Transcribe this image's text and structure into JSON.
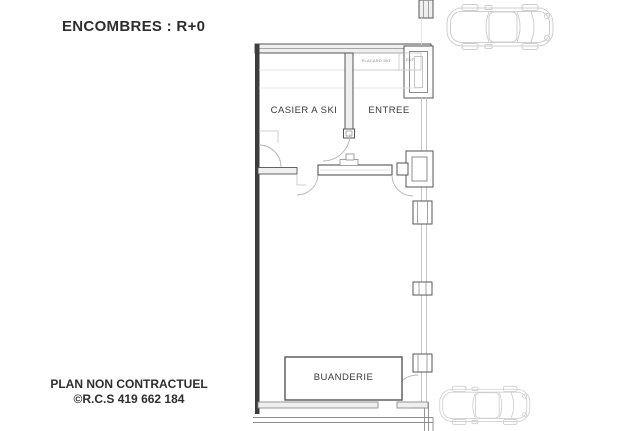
{
  "page": {
    "title": "ENCOMBRES : R+0",
    "footer": {
      "line1": "PLAN NON CONTRACTUEL",
      "line2": "©R.C.S 419 662 184"
    }
  },
  "plan": {
    "rooms": {
      "casier_a_ski": "CASIER A SKI",
      "entree": "ENTREE",
      "buanderie": "BUANDERIE"
    },
    "annotations": {
      "placard_ski": "PLACARD SKI",
      "edf": "EDF"
    },
    "icons": {
      "car_top": "car-top-icon",
      "car_bottom": "car-bottom-icon"
    },
    "colors": {
      "wall_dark": "#3d3d3d",
      "wall_line": "#555555",
      "wall_light": "#c4c4c4",
      "door_arc": "#b5b5b5",
      "car_outline": "#cfcfcf",
      "text": "#2e2e2e",
      "background": "#ffffff"
    }
  }
}
